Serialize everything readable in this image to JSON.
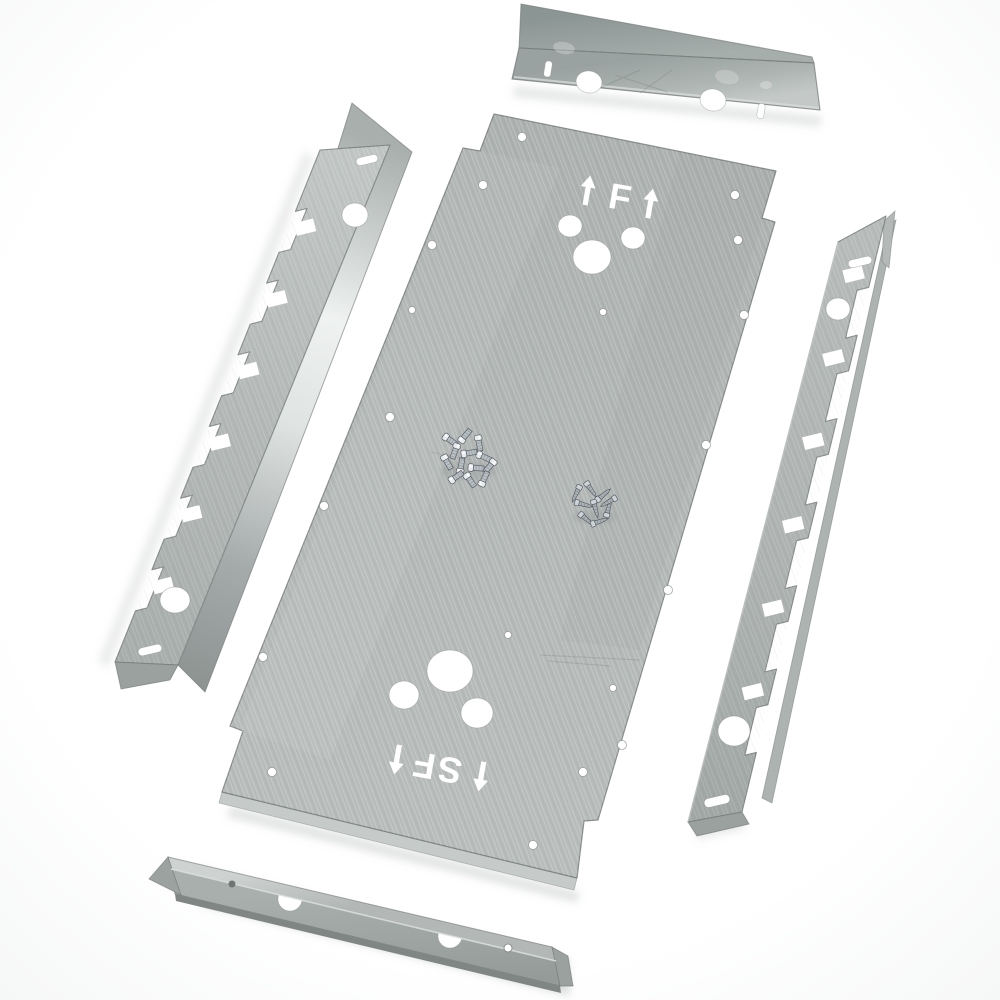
{
  "image_type": "product-photo",
  "subject": "Galvanized sheet-metal mounting plate kit: one large stencil-marked mounting plate, two toothed side rails, two angle brackets and two piles of assembly screws on a white background",
  "background_color": "#ffffff",
  "palette": {
    "metal_base": "#b2b7b5",
    "metal_light": "#dde1df",
    "metal_specular": "#eef1f0",
    "metal_dark": "#868d8b",
    "edge_line": "#6e7573",
    "cutout": "#ffffff",
    "screw_bright": "#e6eaec",
    "screw_dark": "#798188"
  },
  "markings": {
    "top_label": "1F1",
    "top_letter_glyph": "F",
    "top_note": "letter F flanked by two upward arrows, cut out of the plate",
    "bottom_label": "1SF1",
    "bottom_glyphs_displayed": "SF",
    "bottom_note": "marking 1SF1 cut out rotated 180 degrees (appears upside-down)"
  },
  "parts": [
    {
      "name": "top-angle-bracket",
      "type": "angle bracket",
      "round_holes": 2,
      "slots": 2
    },
    {
      "name": "main-mounting-plate",
      "type": "mounting plate",
      "large_holes": 6,
      "small_holes": 19,
      "markings": [
        "1F1",
        "1SF1"
      ]
    },
    {
      "name": "left-toothed-rail",
      "type": "notched mounting rail",
      "round_holes": 2,
      "slots": 2,
      "tooth_notches": 6
    },
    {
      "name": "right-toothed-rail",
      "type": "notched mounting rail",
      "round_holes": 2,
      "slots": 2,
      "tooth_notches": 6
    },
    {
      "name": "bottom-angle-bracket",
      "type": "angle bracket",
      "small_holes": 2,
      "half_round_notches": 2
    },
    {
      "name": "screw-pile-short",
      "type": "pan-head screws",
      "count": 13
    },
    {
      "name": "screw-pile-long",
      "type": "pointed self-tapping screws",
      "count": 9
    }
  ]
}
